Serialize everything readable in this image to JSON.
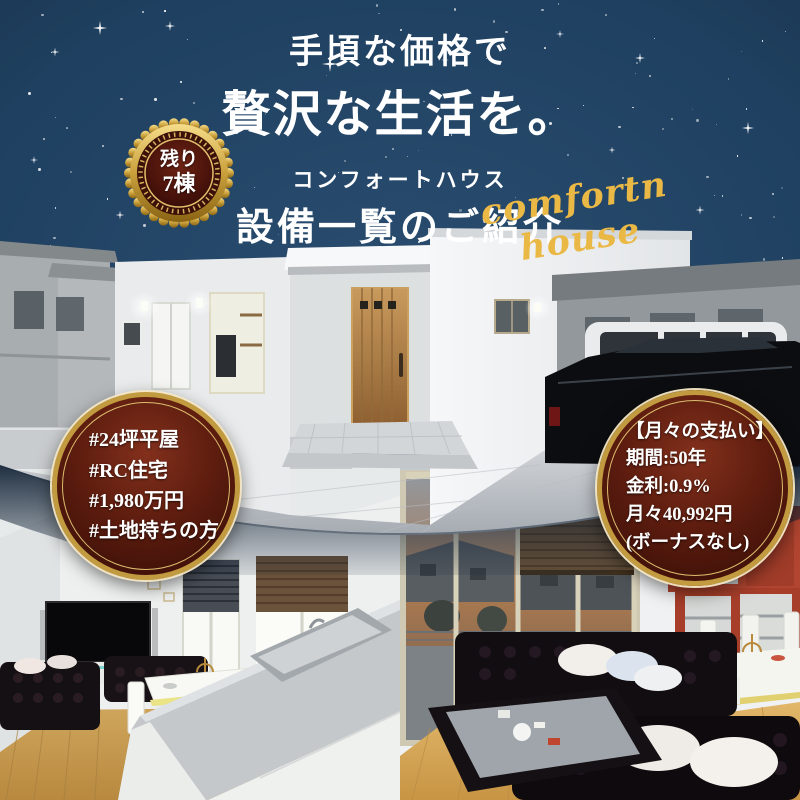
{
  "poster": {
    "title": {
      "line1": "手頃な価格で",
      "line2": "贅沢な生活を。"
    },
    "brand": "コンフォートハウス",
    "heading": "設備一覧のご紹介",
    "script_signature": "comfortn house",
    "remaining_badge": {
      "line1": "残り",
      "line2": "7棟"
    },
    "left_badge": {
      "lines": [
        "#24坪平屋",
        "#RC住宅",
        "#1,980万円",
        "#土地持ちの方"
      ]
    },
    "payment_badge": {
      "lines": [
        "【月々の支払い】",
        "期間:50年",
        "金利:0.9%",
        "月々40,992円",
        "(ボーナスなし)"
      ]
    },
    "colors": {
      "night_sky": "#1f4060",
      "gold": "#e2b14c",
      "badge_maroon": "#5e1d0f",
      "text_white": "#ffffff"
    }
  }
}
